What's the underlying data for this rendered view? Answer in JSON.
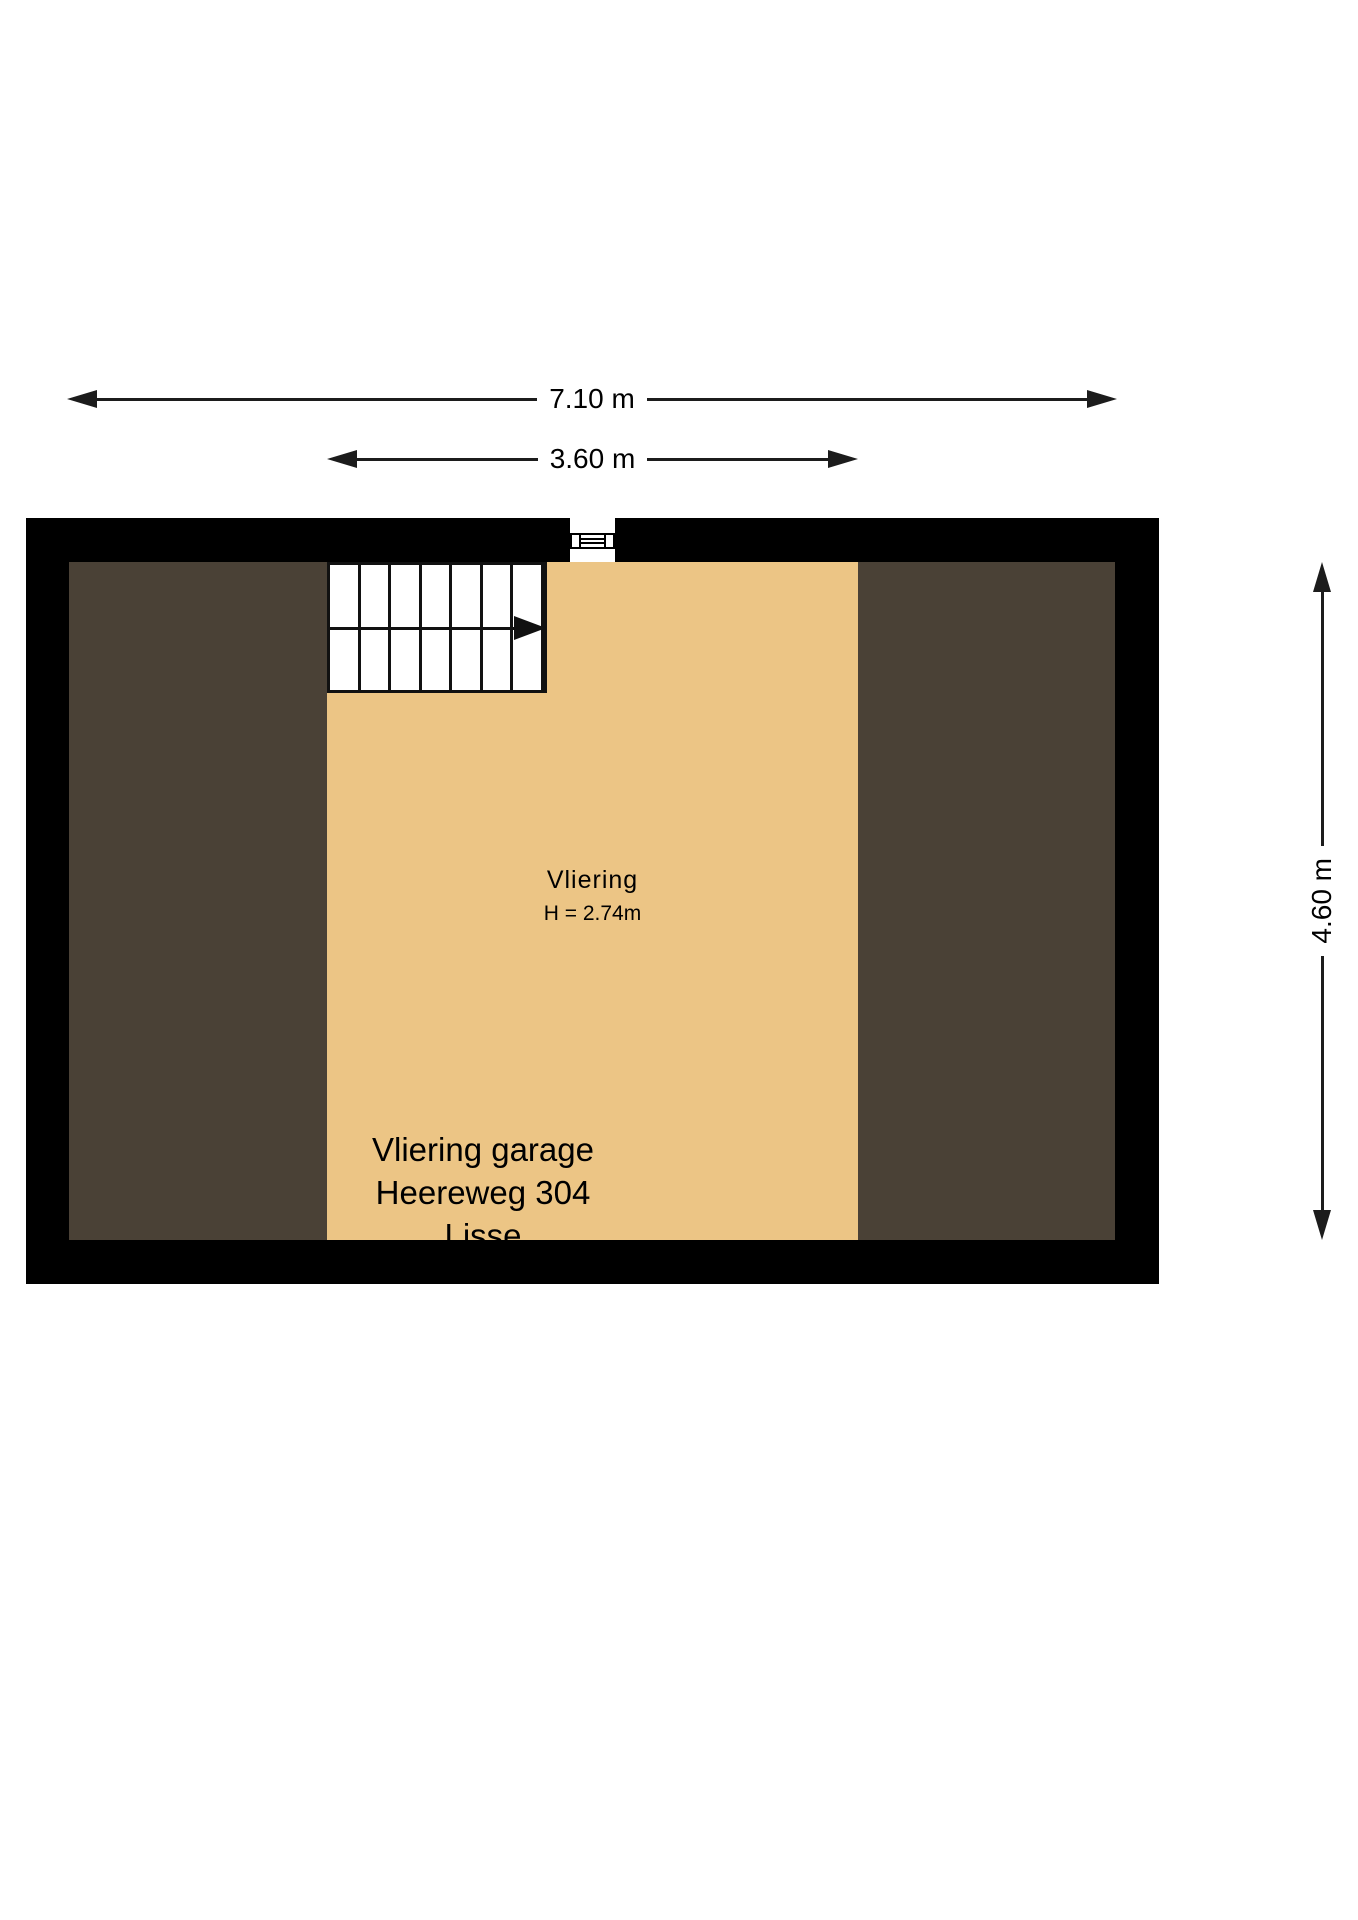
{
  "floorplan": {
    "dimensions": {
      "total_width": "7.10 m",
      "attic_width": "3.60 m",
      "total_depth": "4.60 m"
    },
    "room": {
      "name": "Vliering",
      "ceiling_height": "H = 2.74m"
    },
    "caption": {
      "line1": "Vliering garage",
      "line2": "Heereweg 304",
      "line3": "Lisse"
    },
    "colors": {
      "wall": "#000000",
      "attic_floor": "#ecc585",
      "roof_space": "#4a4136",
      "dimension_line": "#1c1c1c"
    }
  }
}
